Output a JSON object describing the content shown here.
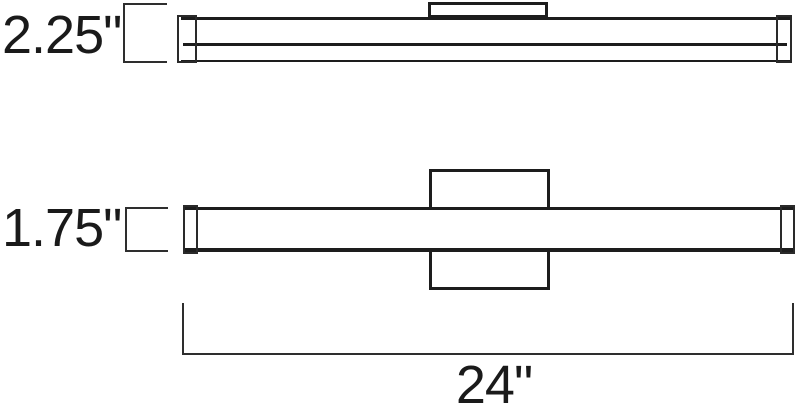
{
  "diagram": {
    "colors": {
      "ink": "#1d1d1d",
      "dimension_line": "#2e2e2e",
      "background": "#ffffff"
    },
    "side_view": {
      "depth_dimension": {
        "label": "2.25\""
      }
    },
    "front_view": {
      "height_dimension": {
        "label": "1.75\""
      },
      "width_dimension": {
        "label": "24\""
      }
    }
  }
}
